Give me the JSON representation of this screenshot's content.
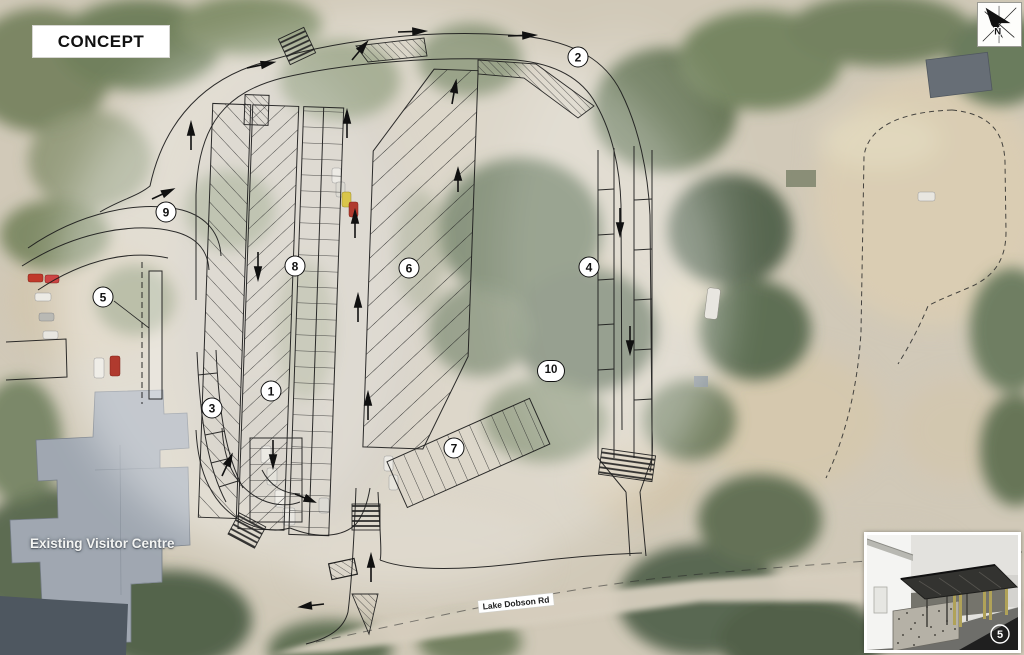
{
  "title_block": {
    "label": "CONCEPT"
  },
  "north": {
    "letter": "N"
  },
  "map_labels": {
    "building": "Existing Visitor Centre",
    "road": "Lake Dobson Rd"
  },
  "markers": [
    {
      "label": "1",
      "x": 271,
      "y": 391
    },
    {
      "label": "2",
      "x": 578,
      "y": 57
    },
    {
      "label": "3",
      "x": 212,
      "y": 408
    },
    {
      "label": "4",
      "x": 589,
      "y": 267
    },
    {
      "label": "5",
      "x": 103,
      "y": 297
    },
    {
      "label": "6",
      "x": 409,
      "y": 268
    },
    {
      "label": "7",
      "x": 454,
      "y": 448
    },
    {
      "label": "8",
      "x": 295,
      "y": 266
    },
    {
      "label": "9",
      "x": 166,
      "y": 212
    },
    {
      "label": "10",
      "x": 551,
      "y": 371
    }
  ],
  "inset": {
    "badge": "5"
  },
  "colors": {
    "plan_line": "#1c1c1c",
    "marker_bg": "#ffffff",
    "tree_green": "#5d6d4c",
    "gravel_tan": "#d6c9ad",
    "roof_gray": "#9ba3ad",
    "label_bg": "#ffffff"
  }
}
